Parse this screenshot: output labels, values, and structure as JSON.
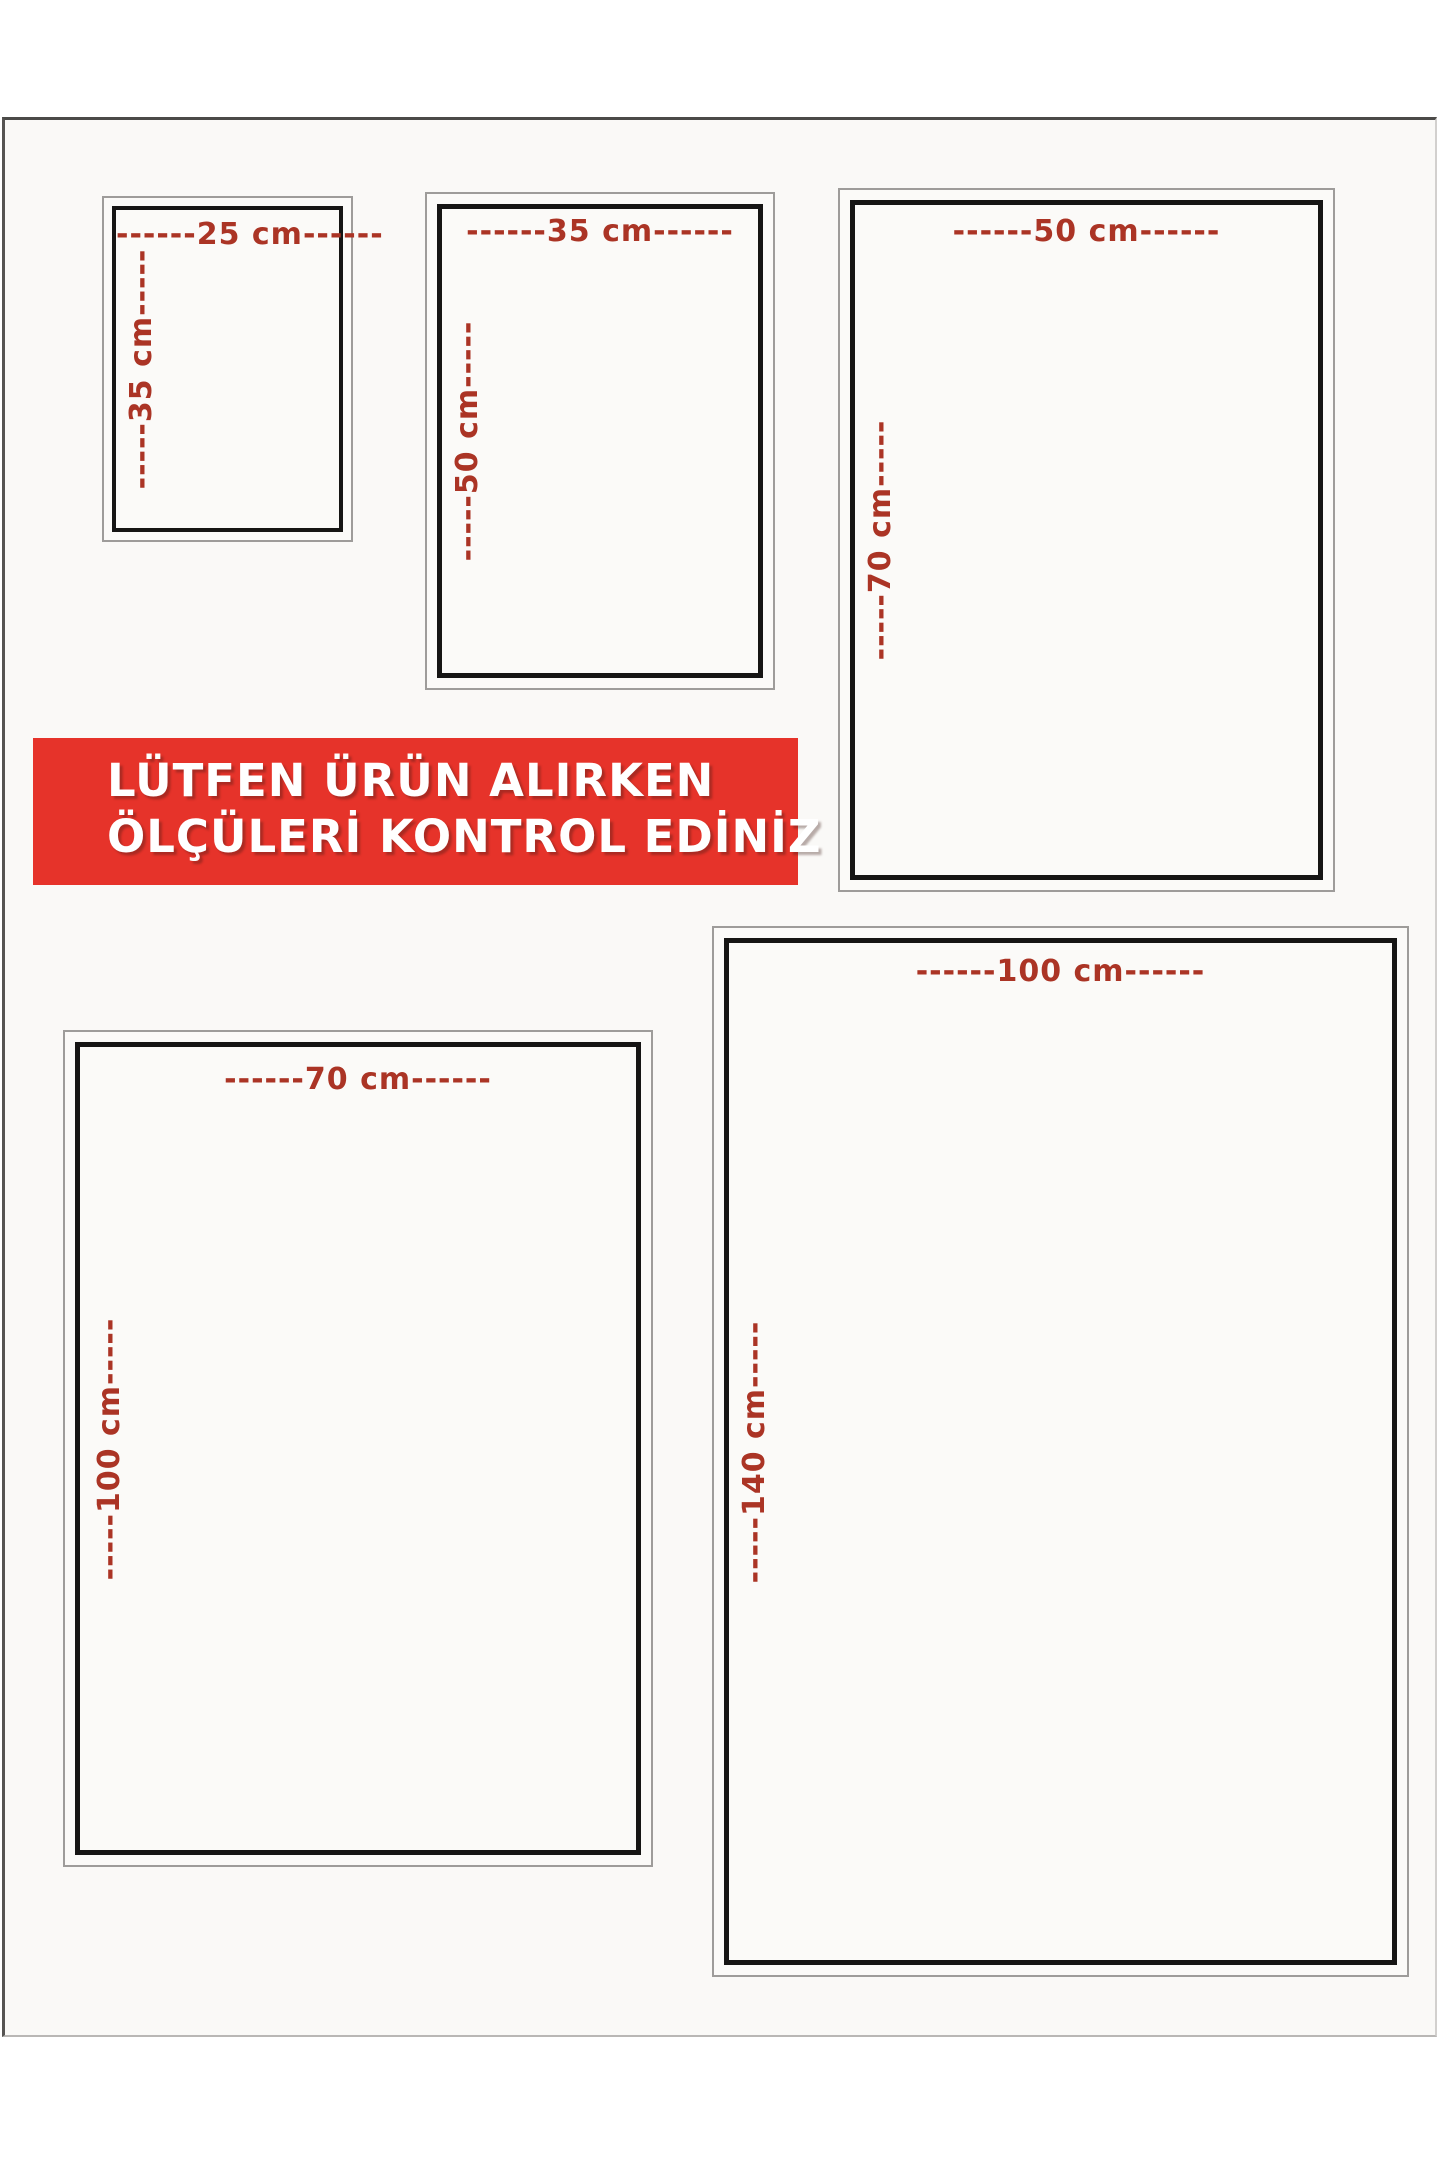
{
  "banner": {
    "line1": "LÜTFEN ÜRÜN ALIRKEN",
    "line2": "ÖLÇÜLERİ KONTROL EDİNİZ",
    "bg_color": "#e6332a",
    "text_color": "#ffffff"
  },
  "label_color": "#ab3425",
  "sizes": [
    {
      "name": "25x35",
      "width_cm": 25,
      "height_cm": 35,
      "width_label": "------25 cm------",
      "height_label": "-----35 cm-----"
    },
    {
      "name": "35x50",
      "width_cm": 35,
      "height_cm": 50,
      "width_label": "------35 cm------",
      "height_label": "-----50 cm-----"
    },
    {
      "name": "50x70",
      "width_cm": 50,
      "height_cm": 70,
      "width_label": "------50 cm------",
      "height_label": "-----70 cm-----"
    },
    {
      "name": "70x100",
      "width_cm": 70,
      "height_cm": 100,
      "width_label": "------70 cm------",
      "height_label": "-----100 cm-----"
    },
    {
      "name": "100x140",
      "width_cm": 100,
      "height_cm": 140,
      "width_label": "------100 cm------",
      "height_label": "-----140 cm-----"
    }
  ]
}
